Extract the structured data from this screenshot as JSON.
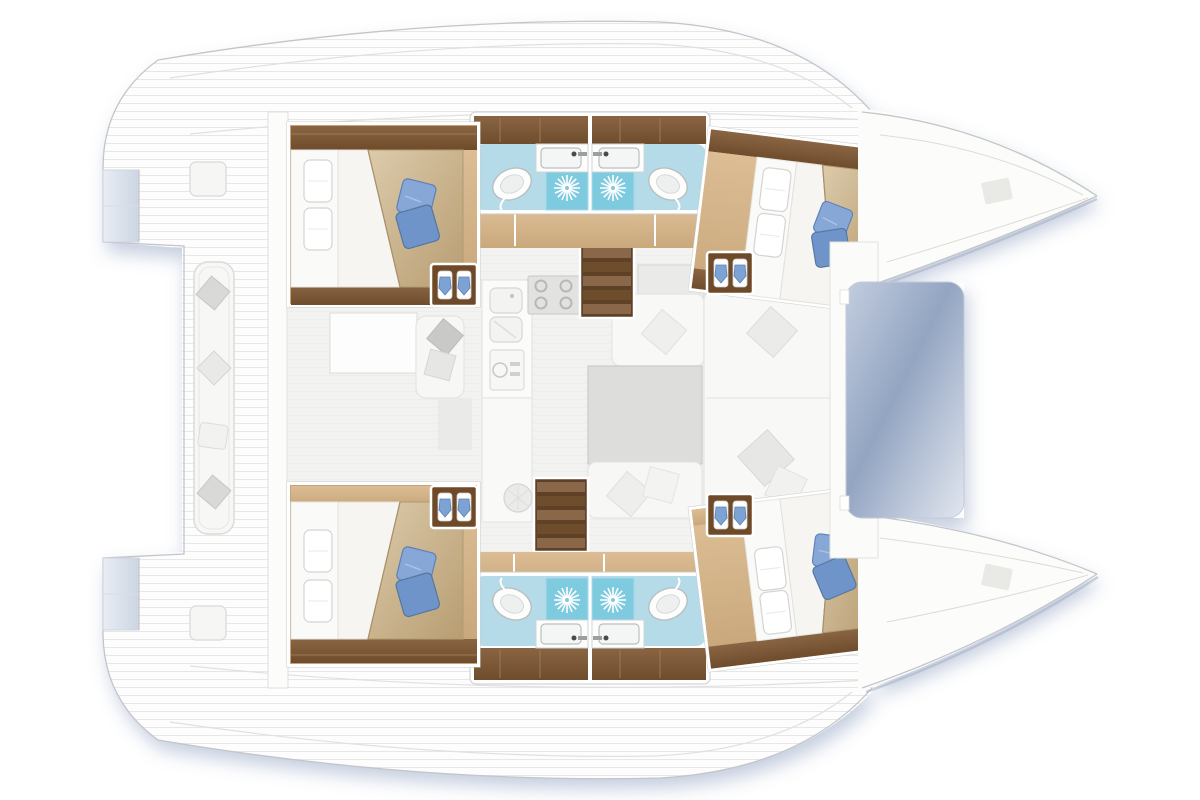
{
  "meta": {
    "title": "Catamaran interior layout floor plan",
    "view": "top-down deck plan",
    "orientation": "bow to the right, stern to the left",
    "accommodation": "4 double cabins, 4 shower rooms, saloon with galley, aft cockpit, bow trampoline"
  },
  "colors": {
    "hull_white": "#fcfcfa",
    "outline_gray": "#c2c5c9",
    "shadow_blue": "#7f93b8",
    "deck_plank_line": "#e7e7e5",
    "wood_dark": "#6e4c2c",
    "wood_mid": "#8a6544",
    "wood_floor": "#d2b289",
    "wood_floor_dark": "#bf9a6e",
    "blanket_beige": "#cdb891",
    "blanket_dark": "#b39a6e",
    "pillow_blue": "#7da2d4",
    "pillow_blue_dark": "#5c80b6",
    "bathroom_tile": "#b5dbe9",
    "shower_tile": "#7ecadf",
    "porcelain_white": "#fdfdfb",
    "saloon_floor": "#f2f2f0",
    "furniture_white": "#f7f7f5",
    "table_gray": "#dddddb",
    "cushion_gray": "#d9d9d7",
    "trampoline_dark": "#93a5c2",
    "trampoline_light": "#e2e6ef"
  },
  "rooms": {
    "cockpit": {
      "label": "Aft cockpit with bench seating and scatter cushions"
    },
    "transom_port": {
      "label": "Port transom steps"
    },
    "transom_starboard": {
      "label": "Starboard transom steps"
    },
    "saloon": {
      "label": "Saloon with galley and dinette"
    },
    "galley": {
      "label": "Galley: double sink, 4-burner stove, faucet, refrigerator"
    },
    "stairs_port": {
      "label": "Companionway steps down to port hull"
    },
    "stairs_starboard": {
      "label": "Companionway steps down to starboard hull"
    },
    "corridor_port": {
      "label": "Port hull corridor"
    },
    "corridor_starboard": {
      "label": "Starboard hull corridor"
    },
    "cabin_aft_port": {
      "label": "Aft port double cabin with blue pillows"
    },
    "cabin_fwd_port": {
      "label": "Forward port double cabin with blue pillows"
    },
    "cabin_aft_starboard": {
      "label": "Aft starboard double cabin with blue pillows"
    },
    "cabin_fwd_starboard": {
      "label": "Forward starboard double cabin with blue pillows"
    },
    "bathroom_port": {
      "label": "Port hull bathrooms: two showers, two washbasins, two toilets"
    },
    "bathroom_starboard": {
      "label": "Starboard hull bathrooms: two showers, two washbasins, two toilets"
    },
    "entry_steps": {
      "label": "Hull entry steps with stowed gear"
    },
    "foredeck": {
      "label": "Foredeck crossbeam"
    },
    "trampoline": {
      "label": "Bow trampoline net"
    },
    "bow_port": {
      "label": "Port bow with deck hatch"
    },
    "bow_starboard": {
      "label": "Starboard bow with deck hatch"
    }
  }
}
